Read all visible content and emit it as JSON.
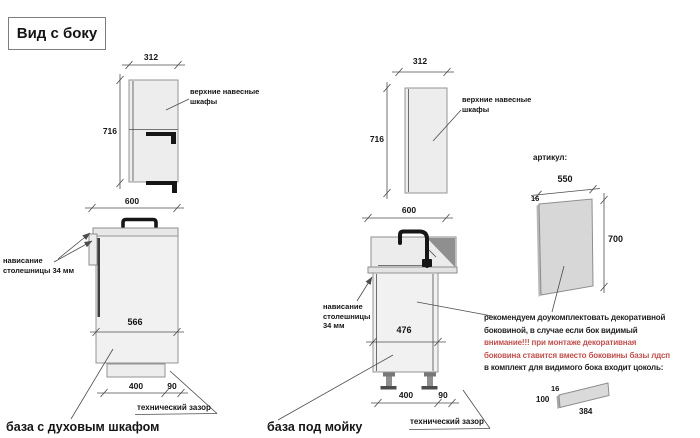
{
  "title": "Вид с боку",
  "left_group": {
    "wall": {
      "width_mm": "312",
      "height_mm": "716",
      "label": "верхние навесные шкафы"
    },
    "base": {
      "width_mm": "600",
      "inner_depth_mm": "566",
      "overhang_label": "нависание столешницы 34 мм",
      "plinth_mm": "400",
      "gap_mm": "90",
      "gap_label": "технический зазор",
      "caption": "база с духовым шкафом"
    }
  },
  "middle_group": {
    "wall": {
      "width_mm": "312",
      "height_mm": "716",
      "label": "верхние навесные шкафы"
    },
    "base": {
      "width_mm": "600",
      "inner_depth_mm": "476",
      "overhang_label": "нависание столешницы 34 мм",
      "plinth_mm": "400",
      "gap_mm": "90",
      "gap_label": "технический зазор",
      "caption": "база под мойку"
    }
  },
  "right_group": {
    "artikul_label": "артикул:",
    "side_panel": {
      "width_mm": "550",
      "thickness_mm": "16",
      "height_mm": "700"
    },
    "note_lines": [
      {
        "text": "рекомендуем доукомплектовать декоративной",
        "color": "#1f1f1f"
      },
      {
        "text": "боковиной, в случае если бок видимый",
        "color": "#1f1f1f"
      },
      {
        "text": "внимание!!! при монтаже декоративная",
        "color": "#c0504d"
      },
      {
        "text": "боковина ставится вместо боковины базы лдсп",
        "color": "#c0504d"
      },
      {
        "text": "в комплект для видимого бока входит цоколь:",
        "color": "#1f1f1f"
      }
    ],
    "plinth": {
      "thickness_mm": "16",
      "height_mm": "100",
      "length_mm": "384"
    }
  },
  "colors": {
    "cabinet_fill": "#efefef",
    "panel_fill": "#d7d7d7",
    "sink_shadow": "#8f8f8f",
    "warning_red": "#c0504d"
  }
}
